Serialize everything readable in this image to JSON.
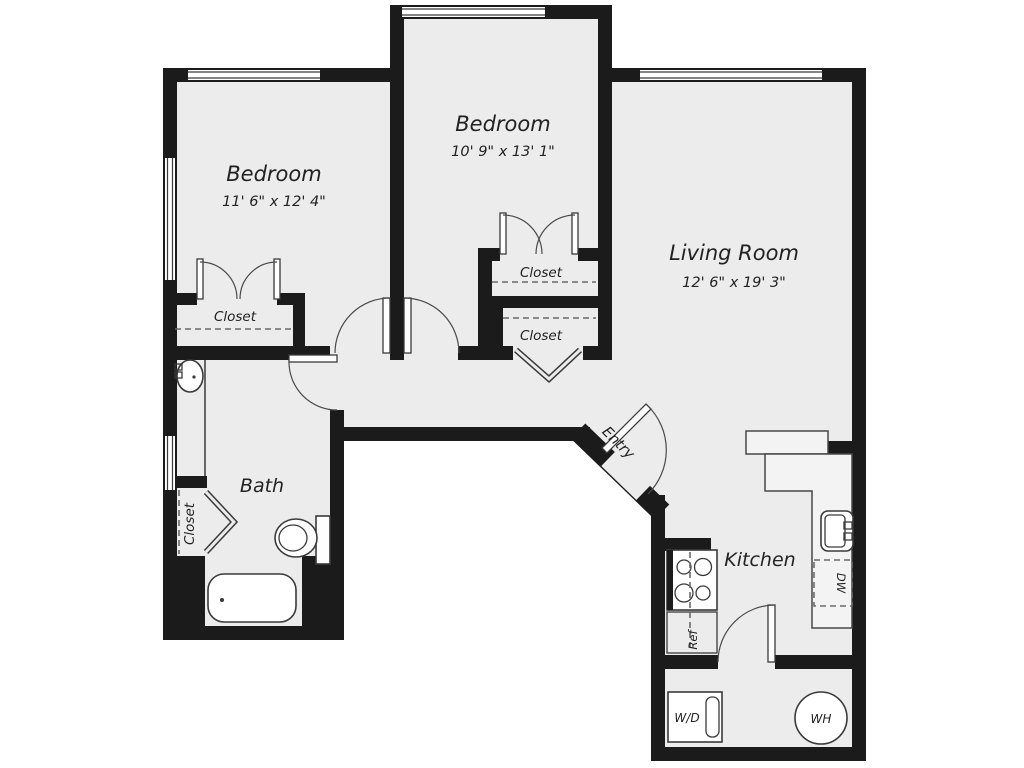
{
  "floor_plan": {
    "rooms": {
      "bedroom_left": {
        "label": "Bedroom",
        "dimensions": "11' 6\" x 12' 4\""
      },
      "bedroom_middle": {
        "label": "Bedroom",
        "dimensions": "10' 9\" x 13' 1\""
      },
      "living_room": {
        "label": "Living Room",
        "dimensions": "12' 6\" x 19' 3\""
      },
      "bath": {
        "label": "Bath"
      },
      "kitchen": {
        "label": "Kitchen"
      },
      "entry": {
        "label": "Entry"
      }
    },
    "closets": {
      "bedroom_left": {
        "label": "Closet"
      },
      "bedroom_middle_upper": {
        "label": "Closet"
      },
      "bedroom_middle_lower": {
        "label": "Closet"
      },
      "bath": {
        "label": "Closet"
      }
    },
    "appliances": {
      "washer_dryer": {
        "label": "W/D"
      },
      "water_heater": {
        "label": "WH"
      },
      "refrigerator": {
        "label": "Ref"
      },
      "dishwasher": {
        "label": "DW"
      }
    },
    "colors": {
      "wall": "#1b1b1b",
      "floor": "#ececec",
      "background": "#ffffff"
    }
  }
}
